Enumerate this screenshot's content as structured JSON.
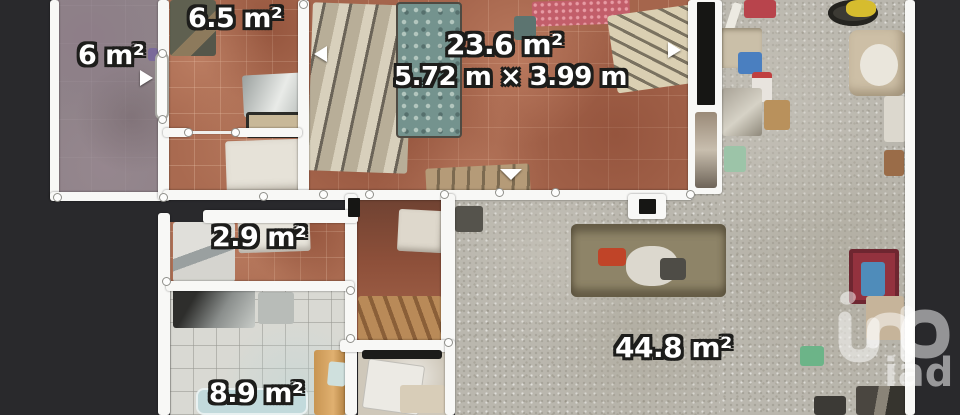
{
  "background_color": "#29292c",
  "rooms": [
    {
      "id": "room-6",
      "area_label": "6 m²"
    },
    {
      "id": "room-6-5",
      "area_label": "6.5 m²"
    },
    {
      "id": "room-23-6",
      "area_label": "23.6 m²",
      "dimensions_label": "5.72 m × 3.99 m"
    },
    {
      "id": "room-2-9",
      "area_label": "2.9 m²"
    },
    {
      "id": "room-8-9",
      "area_label": "8.9 m²"
    },
    {
      "id": "room-44-8",
      "area_label": "44.8 m²"
    }
  ],
  "watermark": {
    "brand": "iad"
  },
  "colors": {
    "wall": "#f8f8f6",
    "terracotta_floor": "#a96a50",
    "mauve_floor": "#8f8389",
    "concrete_floor": "#bab7ae",
    "tile_floor": "#d9d9d3",
    "label_text": "#ffffff",
    "door_marker": "#161614"
  }
}
